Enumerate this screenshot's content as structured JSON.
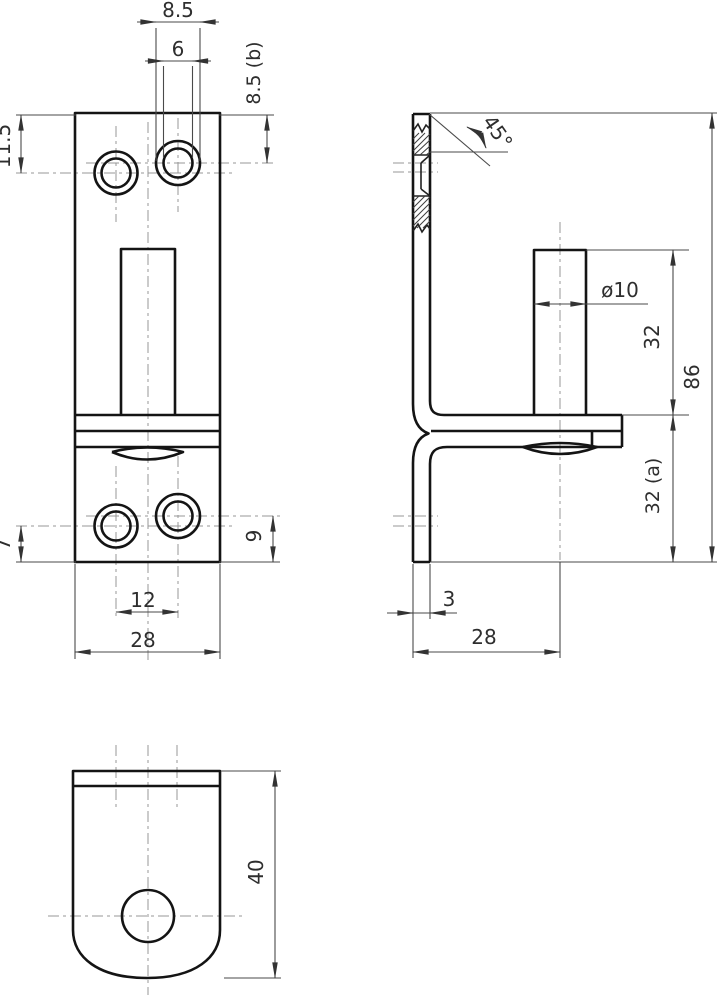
{
  "drawing": {
    "kind": "three-view technical drawing of a bracket with pin",
    "colors": {
      "background": "#ffffff",
      "outline": "#141414",
      "thin_line": "#4a4a4a",
      "centerline": "#979797",
      "text": "#2e2e2e"
    },
    "dims": {
      "front": {
        "counterbore_width": "8.5",
        "hole_width": "6",
        "right_hole_offset": "8.5 (b)",
        "left_hole_offset": "11.5",
        "bottom_left_offset": "7",
        "bottom_right_offset": "9",
        "hole_pitch": "12",
        "plate_width": "28"
      },
      "side": {
        "chamfer_angle": "45°",
        "pin_diameter": "ø10",
        "pin_height": "32",
        "total_height": "86",
        "lower_height": "32 (a)",
        "plate_thickness": "3",
        "flange_depth": "28"
      },
      "bottom": {
        "tab_length": "40"
      }
    }
  }
}
